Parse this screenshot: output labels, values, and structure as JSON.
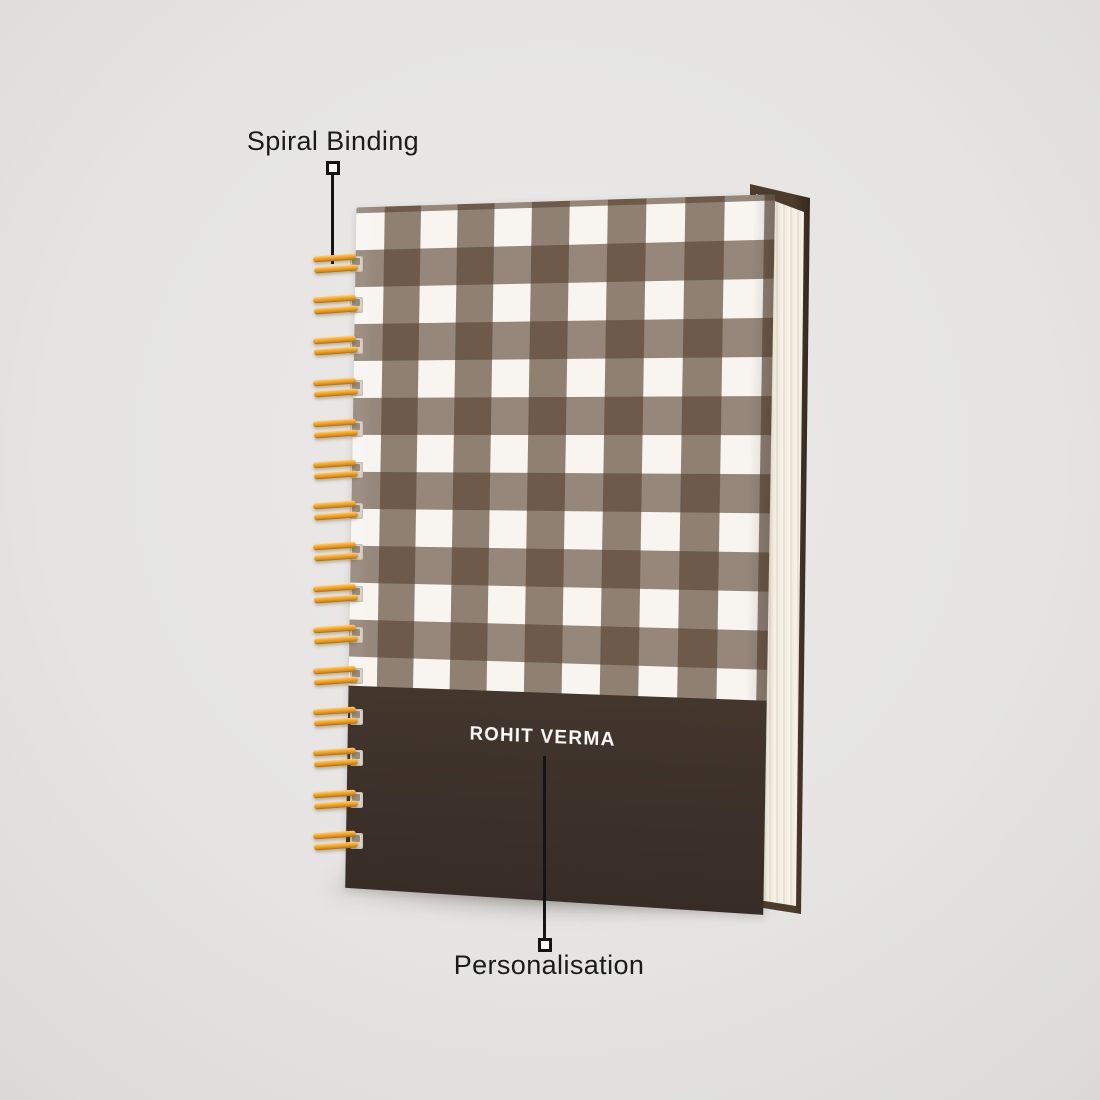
{
  "background_color": "#e6e5e3",
  "annotations": {
    "spiral_binding": {
      "label": "Spiral Binding"
    },
    "personalisation": {
      "label": "Personalisation"
    }
  },
  "notebook": {
    "personalised_name": "ROHIT VERMA",
    "cover_pattern": "gingham-check",
    "colors": {
      "check_white": "#f8f5f1",
      "check_brown": "#8d7d70",
      "check_overlap": "#6a594b",
      "band_brown": "#3c312a",
      "back_cover": "#4d3c2e",
      "page_edges": "#f2ecdf",
      "spiral_gold": "#f3a72e",
      "leader_line": "#141414"
    },
    "spiral": {
      "coil_count": 15,
      "spacing_px": 41.2
    }
  }
}
